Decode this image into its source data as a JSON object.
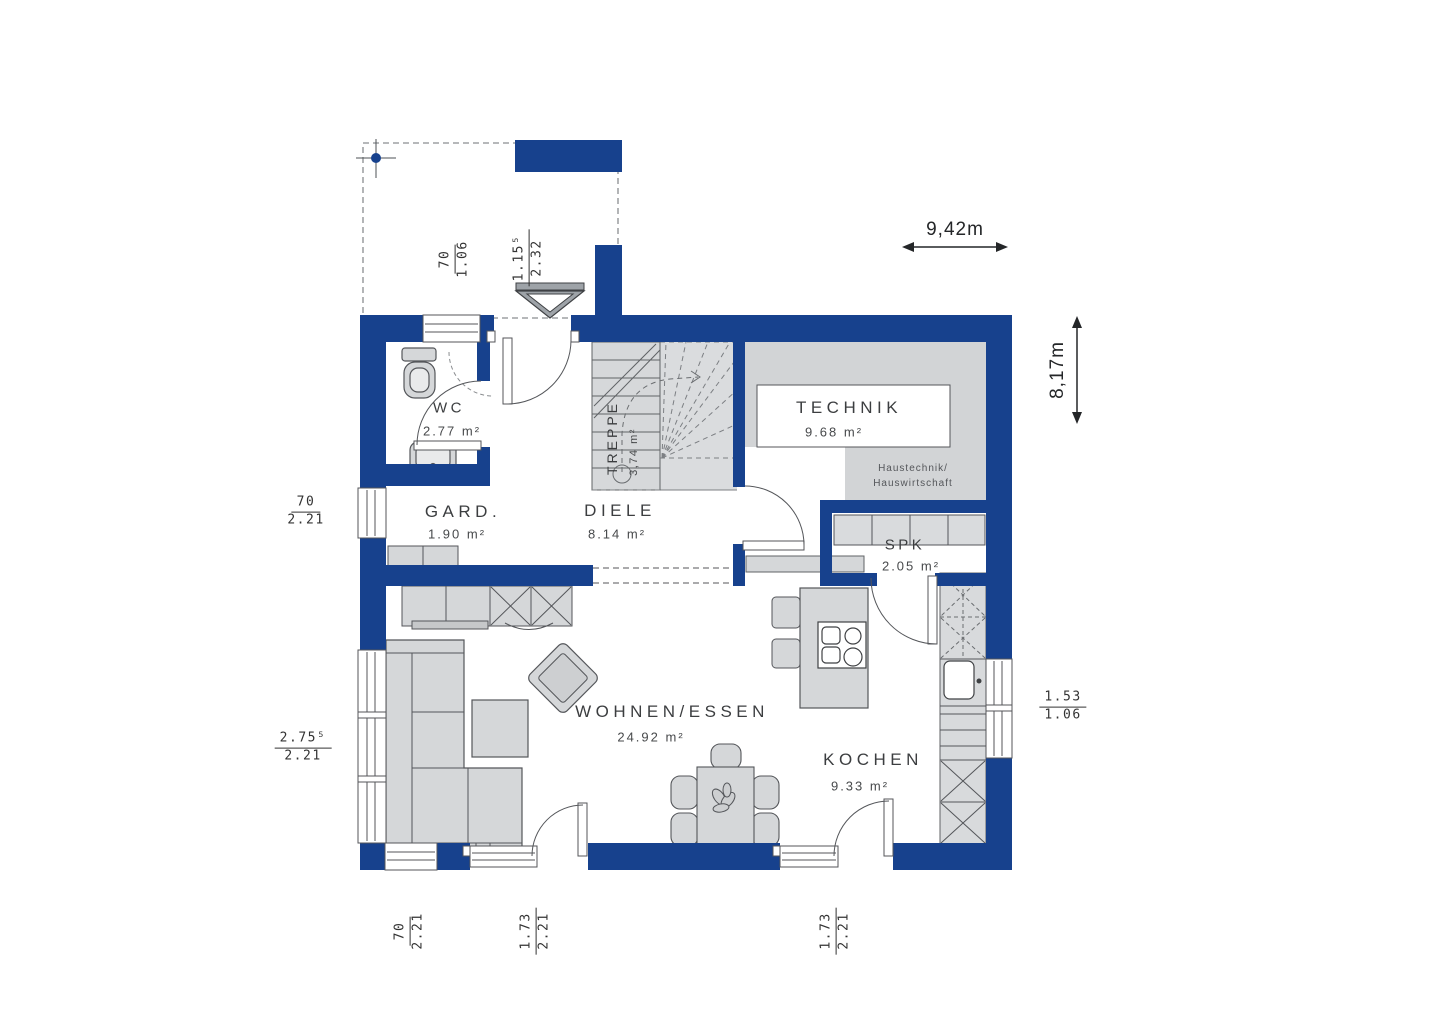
{
  "plan": {
    "rooms": [
      {
        "name": "WC",
        "area": "2.77 m²"
      },
      {
        "name": "GARD.",
        "area": "1.90 m²"
      },
      {
        "name": "DIELE",
        "area": "8.14 m²"
      },
      {
        "name": "TREPPE",
        "area": "3,74 m²"
      },
      {
        "name": "TECHNIK",
        "area": "9.68 m²"
      },
      {
        "name": "SPK",
        "area": "2.05 m²"
      },
      {
        "name": "WOHNEN/ESSEN",
        "area": "24.92 m²"
      },
      {
        "name": "KOCHEN",
        "area": "9.33 m²"
      }
    ],
    "annotations": {
      "technik_note_line1": "Haustechnik/",
      "technik_note_line2": "Hauswirtschaft"
    },
    "overall": {
      "width": "9,42m",
      "height": "8,17m"
    },
    "openings": [
      {
        "id": "wc-window",
        "w": "70",
        "h": "1.06"
      },
      {
        "id": "entry-door",
        "w": "1.15⁵",
        "h": "2.32"
      },
      {
        "id": "gard-window",
        "w": "70",
        "h": "2.21"
      },
      {
        "id": "living-window",
        "w": "2.75⁵",
        "h": "2.21"
      },
      {
        "id": "kitchen-window",
        "w": "1.53",
        "h": "1.06"
      },
      {
        "id": "bottom-window",
        "w": "70",
        "h": "2.21"
      },
      {
        "id": "living-terrace-door",
        "w": "1.73",
        "h": "2.21"
      },
      {
        "id": "kitchen-terrace-door",
        "w": "1.73",
        "h": "2.21"
      }
    ],
    "colors": {
      "wall": "#17418d",
      "furniture": "#d5d7d9",
      "line": "#54565a",
      "text": "#3c3e40"
    }
  }
}
